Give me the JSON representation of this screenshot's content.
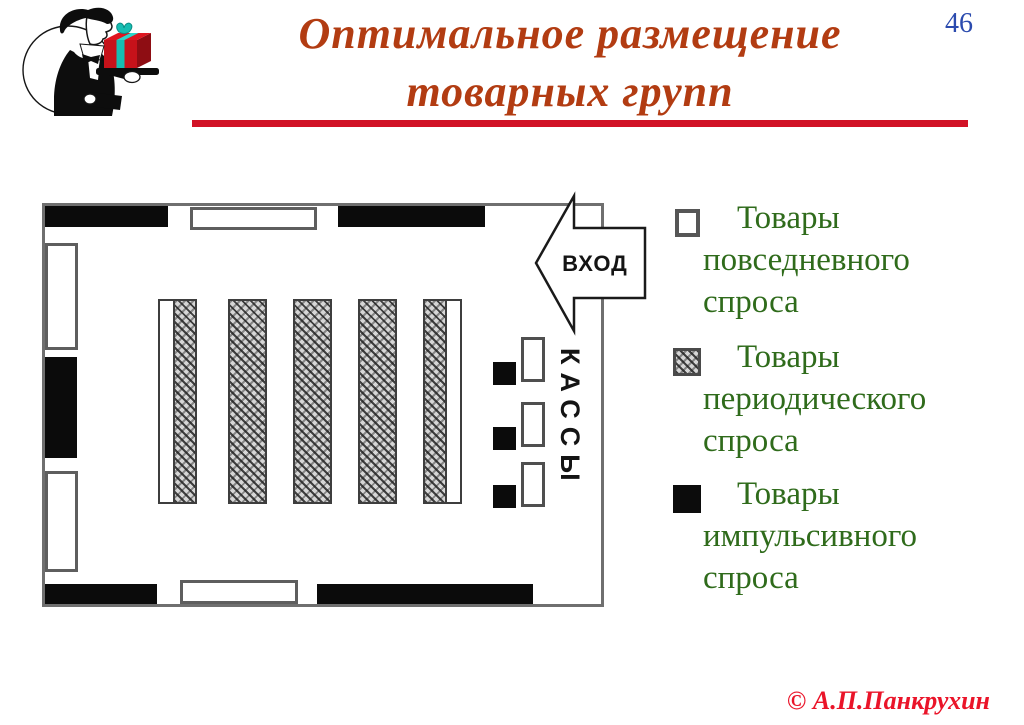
{
  "header": {
    "page_number": "46",
    "title_line1": "Оптимальное размещение",
    "title_line2": "товарных групп"
  },
  "floor_plan": {
    "entrance_label": "ВХОД",
    "checkout_label": "КАССЫ"
  },
  "legend": {
    "items": [
      {
        "swatch": "everyday-goods-swatch",
        "label": "Товары повседневного спроса"
      },
      {
        "swatch": "periodic-goods-swatch",
        "label": "Товары периодического спроса"
      },
      {
        "swatch": "impulse-goods-swatch",
        "label": "Товары импульсивного спроса"
      }
    ]
  },
  "footer": {
    "copyright": "© А.П.Панкрухин"
  },
  "colors": {
    "title": "#b23c12",
    "underline": "#d11226",
    "page_number": "#2b4bae",
    "legend_text": "#2f6b1b",
    "copyright": "#ea1429",
    "wall_fill": "#0b0b0b"
  }
}
